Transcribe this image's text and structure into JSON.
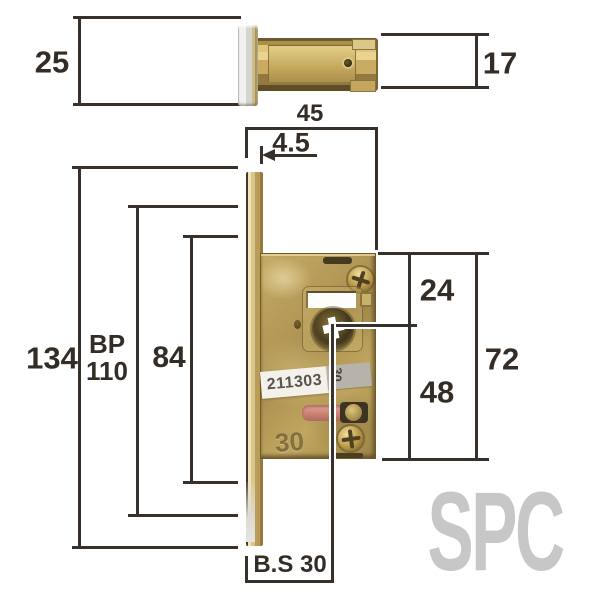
{
  "watermark": "SPC",
  "dims": {
    "d25": "25",
    "d17": "17",
    "d45": "45",
    "d4_5": "4.5",
    "d134": "134",
    "bp_line1": "BP",
    "bp_line2": "110",
    "d84": "84",
    "d24": "24",
    "d72": "72",
    "d48": "48",
    "backset": "B.S 30"
  },
  "lock": {
    "serial": "211303",
    "case_stamp": "30",
    "sticker_mark": "30"
  },
  "colors": {
    "dimension_line": "#38302a",
    "label_text": "#332d26",
    "brass": "#b29853",
    "watermark_gray": "#c7c7c7",
    "latch_paint_pink": "#c97f72"
  }
}
